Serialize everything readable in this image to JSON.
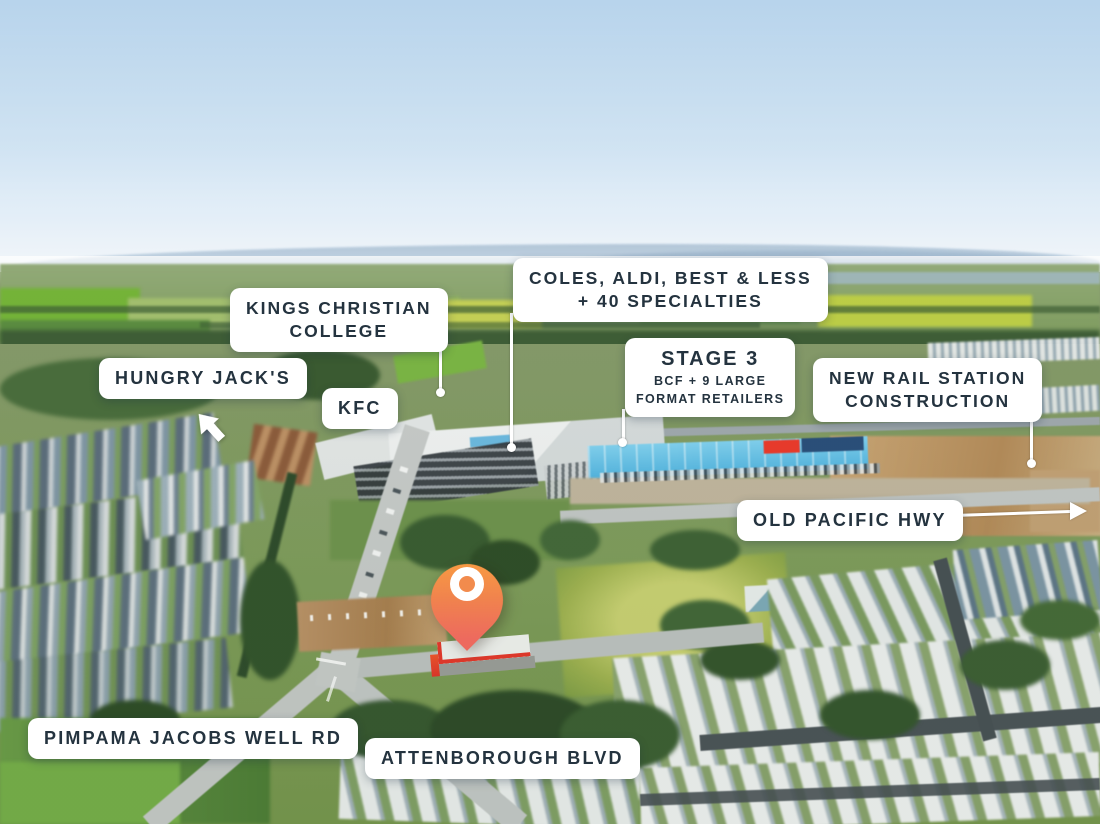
{
  "map_labels": {
    "kings_christian_college": {
      "line1": "KINGS CHRISTIAN",
      "line2": "COLLEGE"
    },
    "coles_precinct": {
      "line1": "COLES, ALDI, BEST & LESS",
      "line2": "+ 40 SPECIALTIES"
    },
    "hungry_jacks": {
      "text": "HUNGRY JACK'S"
    },
    "kfc": {
      "text": "KFC"
    },
    "stage_3": {
      "title": "STAGE 3",
      "line1": "BCF + 9 LARGE",
      "line2": "FORMAT RETAILERS"
    },
    "new_rail_station": {
      "line1": "NEW RAIL STATION",
      "line2": "CONSTRUCTION"
    },
    "old_pacific_hwy": {
      "text": "OLD PACIFIC HWY"
    },
    "pimpama_jacobs_well_rd": {
      "text": "PIMPAMA JACOBS WELL RD"
    },
    "attenborough_blvd": {
      "text": "ATTENBOROUGH BLVD"
    }
  },
  "markers": {
    "location_pin": {
      "description": "subject site location pin",
      "color_top": "#F89B42",
      "color_bottom": "#ED6A5E",
      "ring_color": "#FFFFFF"
    }
  },
  "style": {
    "label_text_color": "#24333F",
    "label_background": "#FFFFFF",
    "connector_color": "#FFFFFF"
  }
}
